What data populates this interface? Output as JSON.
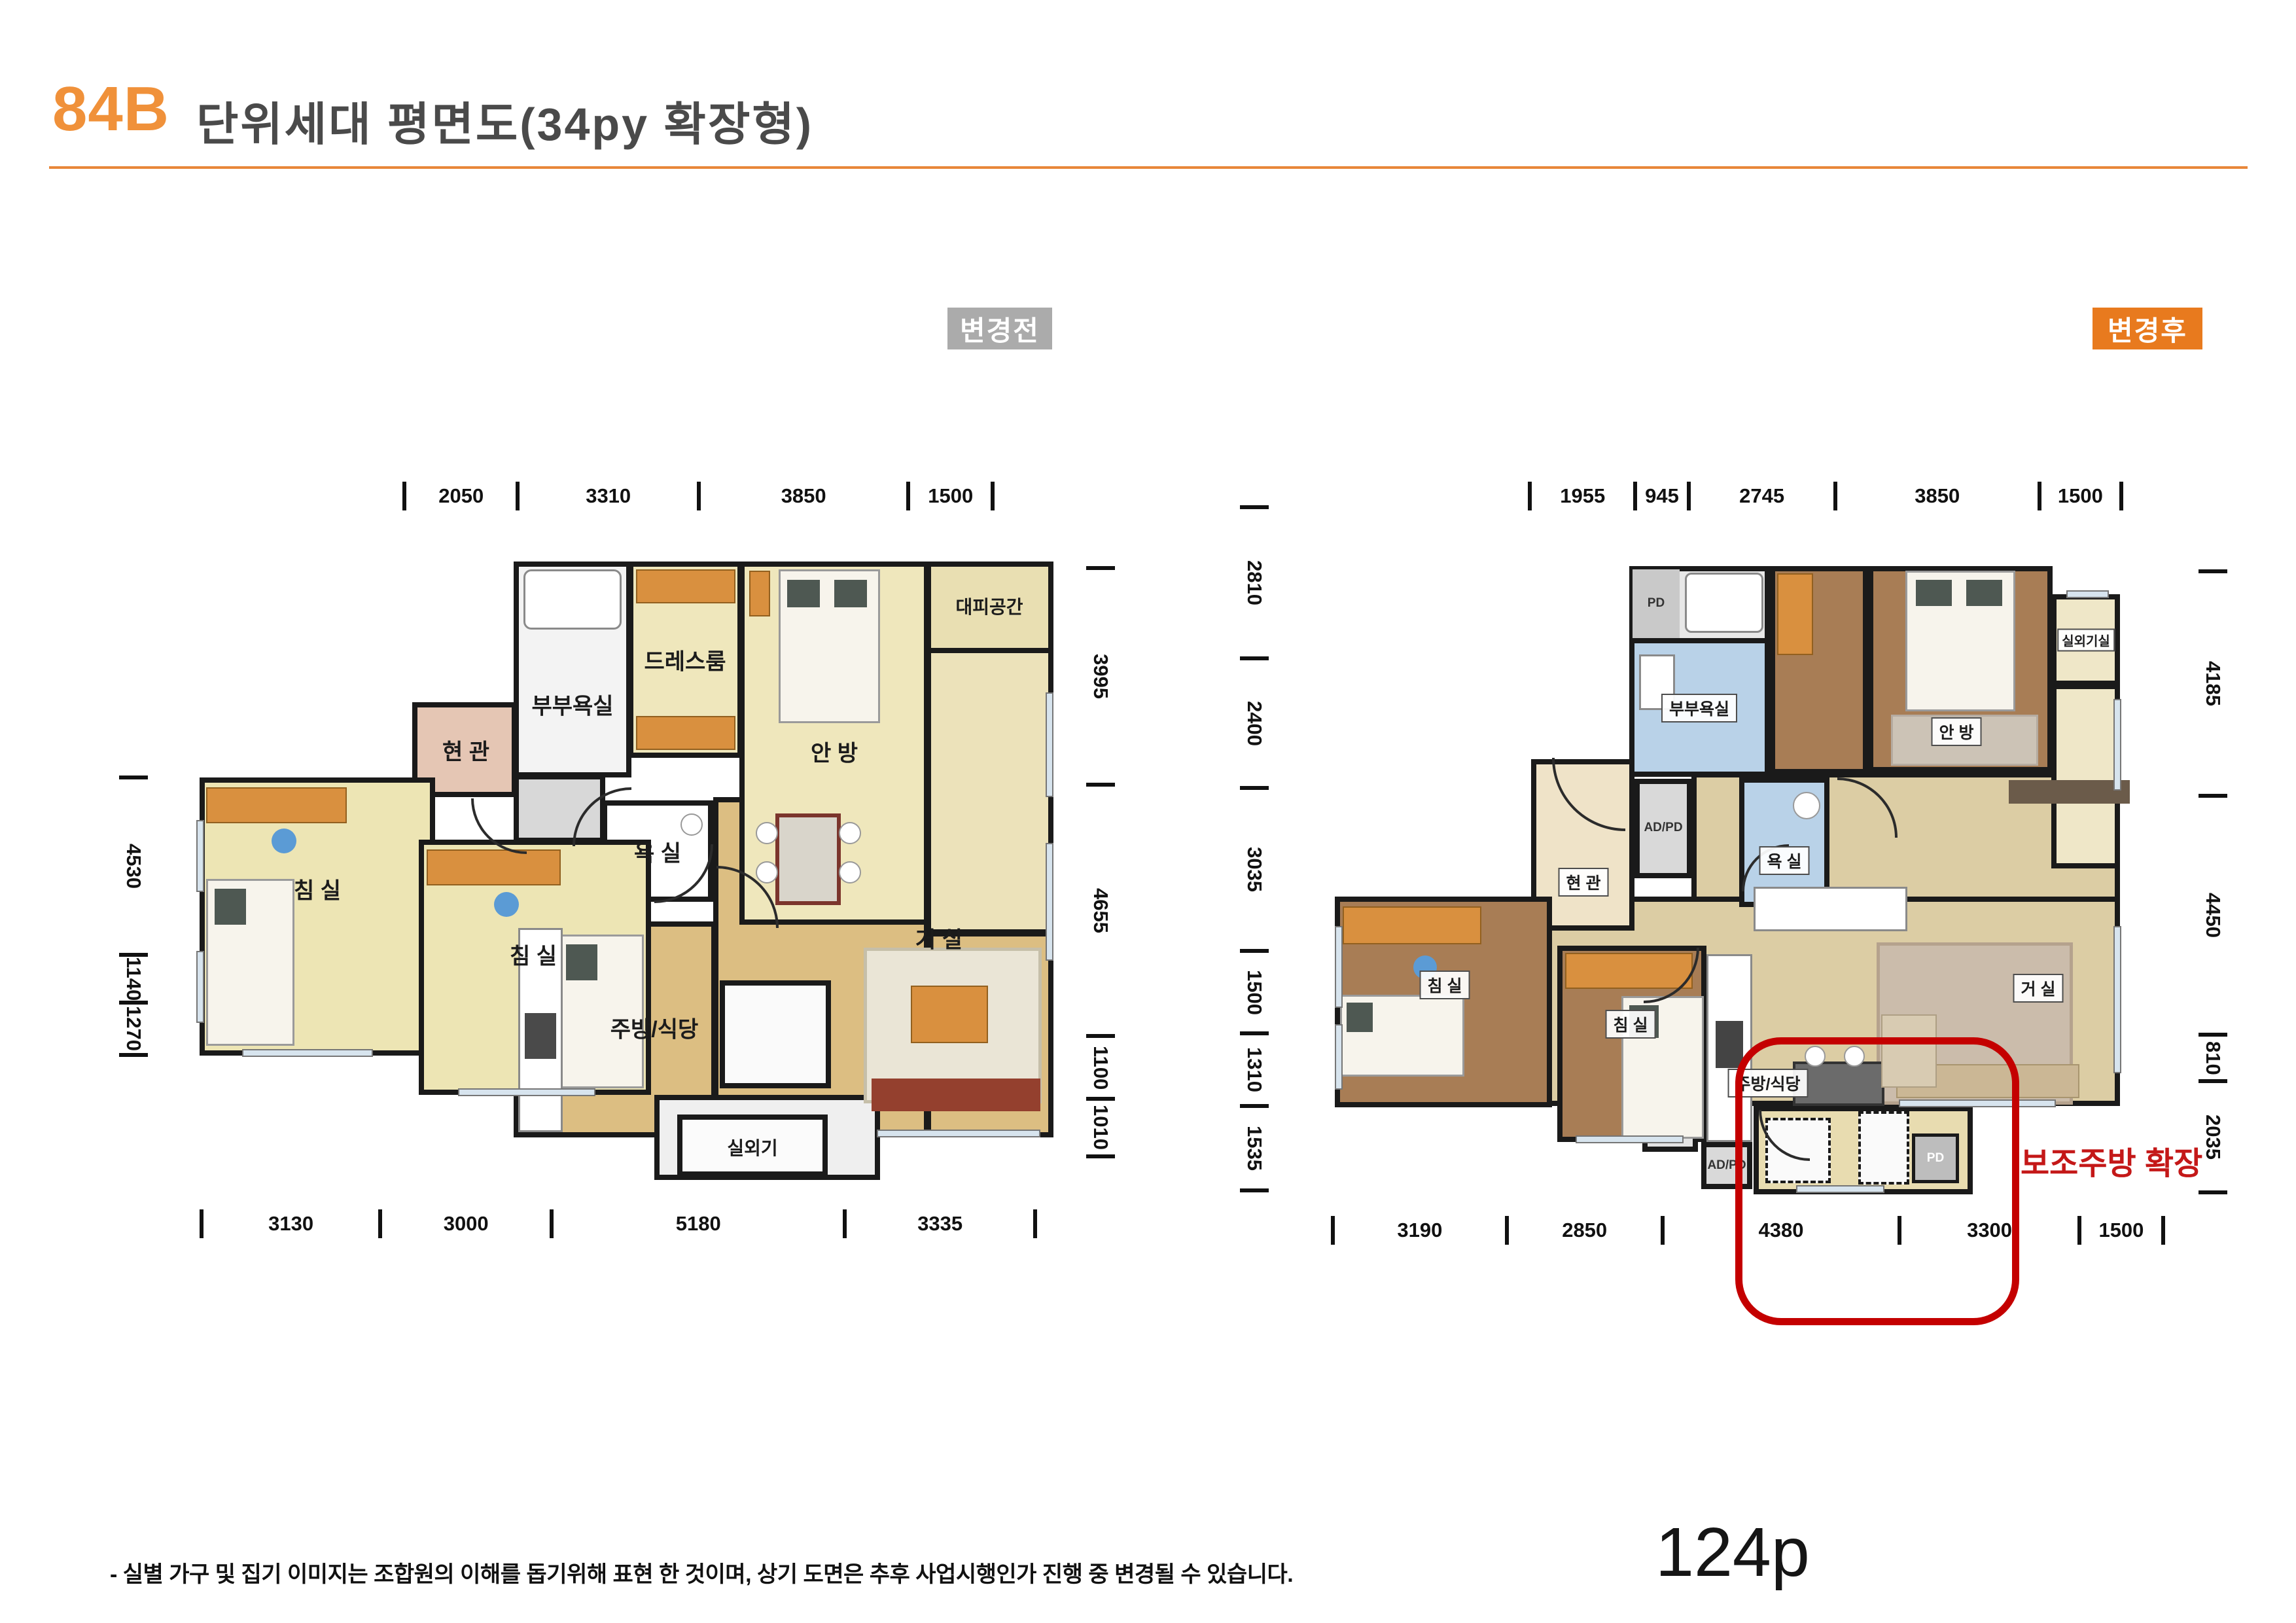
{
  "header": {
    "unit": "84B",
    "title": "단위세대  평면도(34py 확장형)"
  },
  "colors": {
    "accent": "#E8873A",
    "badge_before_bg": "#ABABAB",
    "badge_after_bg": "#E87A1E",
    "highlight": "#C40000"
  },
  "plans": {
    "before": {
      "badge": "변경전",
      "dims": {
        "top": [
          "2050",
          "3310",
          "3850",
          "1500"
        ],
        "bottom": [
          "3130",
          "3000",
          "5180",
          "3335"
        ],
        "left": [
          "4530",
          "1140",
          "1270"
        ],
        "right": [
          "3995",
          "4655",
          "1100",
          "1010"
        ]
      },
      "rooms": {
        "master_bath": "부부욕실",
        "dress_room": "드레스룸",
        "master_bedroom": "안 방",
        "escape_space": "대피공간",
        "entrance": "현 관",
        "bathroom": "욕 실",
        "bedroom1": "침 실",
        "bedroom2": "침 실",
        "kitchen": "주방/식당",
        "living": "거 실",
        "outdoor_unit": "실외기"
      }
    },
    "after": {
      "badge": "변경후",
      "dims": {
        "top": [
          "1955",
          "945",
          "2745",
          "3850",
          "1500"
        ],
        "bottom": [
          "3190",
          "2850",
          "4380",
          "3300",
          "1500"
        ],
        "left": [
          "2810",
          "2400",
          "3035",
          "1500",
          "1310",
          "1535"
        ],
        "right": [
          "4185",
          "4450",
          "810",
          "2035"
        ]
      },
      "rooms": {
        "pd": "PD",
        "master_bath": "부부욕실",
        "master_bedroom": "안 방",
        "outdoor_unit_room": "실외기실",
        "ad_pd": "AD/PD",
        "entrance": "현 관",
        "bathroom": "욕 실",
        "bedroom1": "침 실",
        "bedroom2": "침 실",
        "kitchen": "주방/식당",
        "living": "거 실",
        "ad_pd2": "AD/PD",
        "pd2": "PD"
      },
      "annotation": "보조주방 확장"
    }
  },
  "footer": {
    "disclaimer": "- 실별 가구 및 집기 이미지는 조합원의 이해를  돕기위해 표현 한 것이며,  상기 도면은 추후 사업시행인가  진행 중 변경될 수 있습니다.",
    "page": "124p"
  }
}
